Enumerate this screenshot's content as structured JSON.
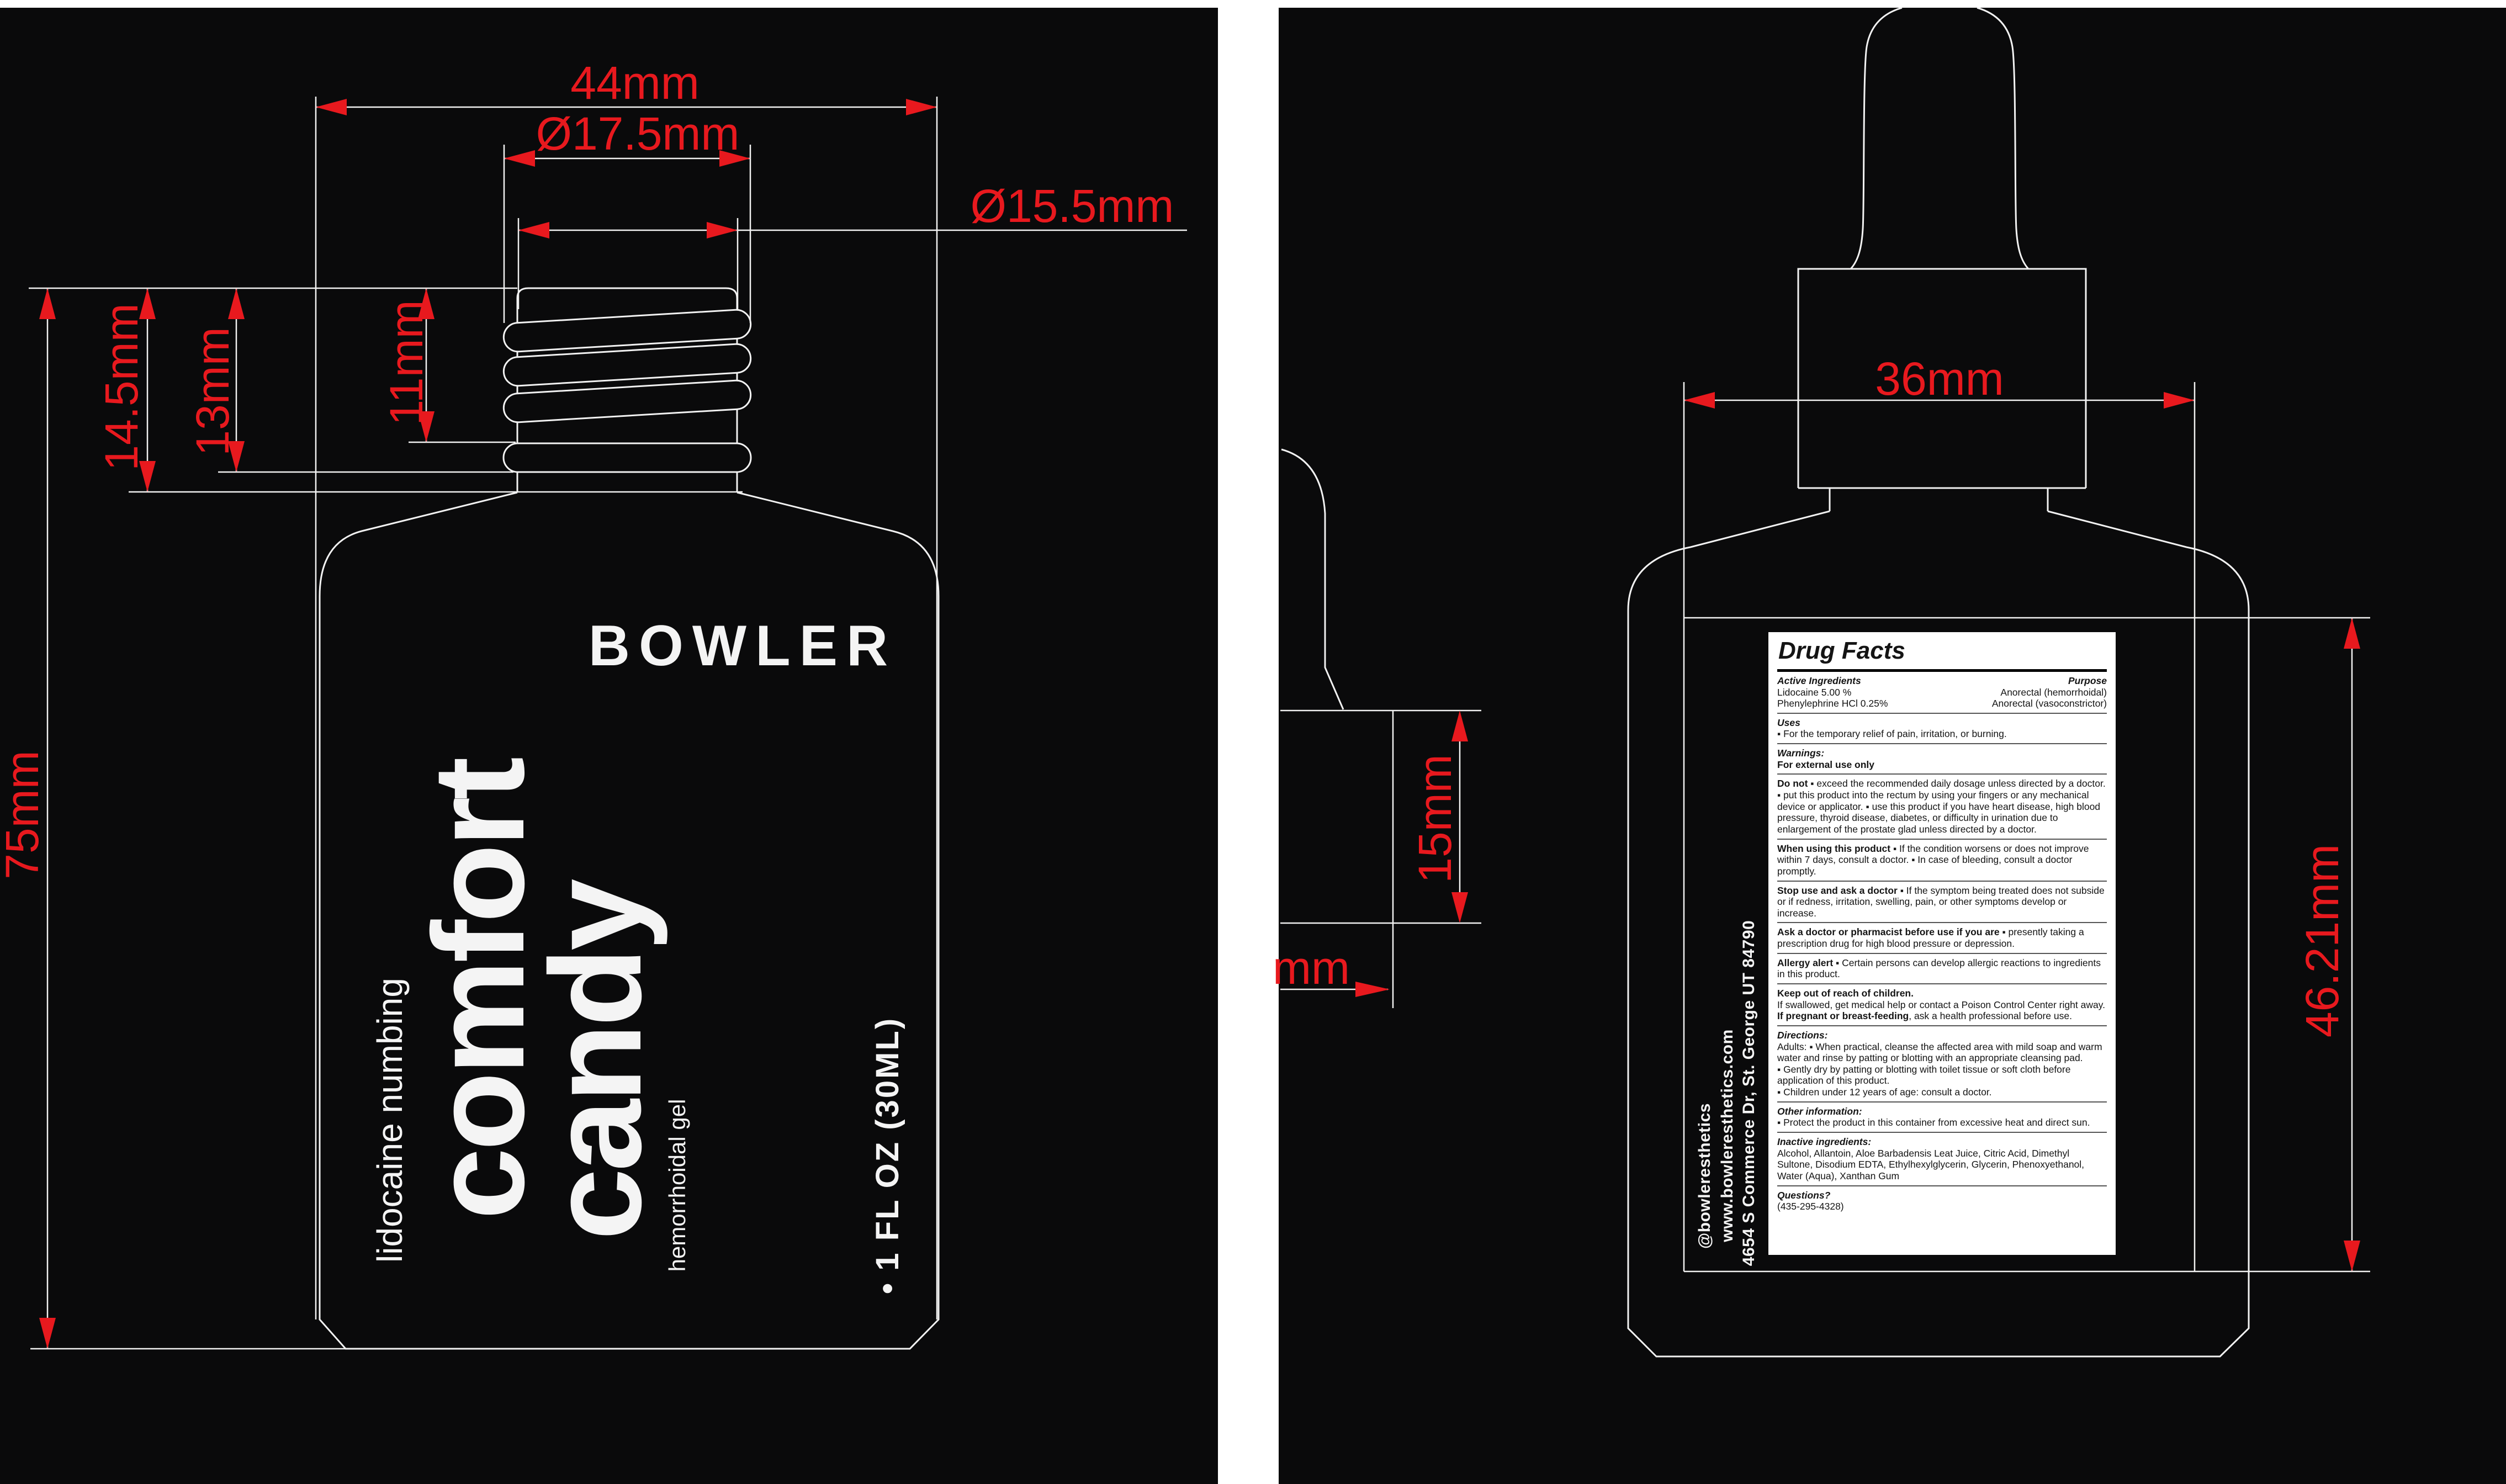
{
  "colors": {
    "accent_red": "#e8191e",
    "line_white": "#f2f2f2",
    "panel_background": "#0a0a0b",
    "label_text": "#f4f4f4"
  },
  "left_view": {
    "dims": {
      "body_width": "44mm",
      "cap_outer_diameter": "Ø17.5mm",
      "cap_diameter": "Ø15.5mm",
      "cap_height": "14.5mm",
      "collar_height": "13mm",
      "thread_height": "11mm",
      "bottle_height": "75mm"
    },
    "label": {
      "brand": "BOWLER",
      "title_line1": "comfort",
      "title_line2": "candy",
      "descriptor": "lidocaine numbing",
      "product_type": "hemorrhoidal gel",
      "volume": "• 1 FL OZ (30ML)"
    }
  },
  "right_view": {
    "dims": {
      "face_width": "36mm",
      "side_offset": "15mm",
      "side_offset_cut": "mm",
      "label_height": "46.21mm"
    },
    "company": {
      "social": "@bowleresthetics",
      "website": "www.bowleresthetics.com",
      "address": "4654 S Commerce Dr, St. George UT 84790"
    },
    "drug_facts": {
      "title": "Drug Facts",
      "active": {
        "heading": "Active Ingredients",
        "purpose_heading": "Purpose",
        "rows": [
          {
            "name": "Lidocaine 5.00 %",
            "purpose": "Anorectal (hemorrhoidal)"
          },
          {
            "name": "Phenylephrine HCl 0.25%",
            "purpose": "Anorectal (vasoconstrictor)"
          }
        ]
      },
      "uses": {
        "heading": "Uses",
        "text": "▪  For the temporary relief of pain, irritation, or burning."
      },
      "warnings": {
        "heading": "Warnings:",
        "text": "For external use only"
      },
      "do_not": {
        "lead": "Do not",
        "text": "  ▪  exceed the recommended daily dosage unless directed by a doctor.   ▪  put this product into the rectum by using your fingers or any mechanical device or applicator.   ▪  use this product if you have heart disease, high blood pressure, thyroid disease, diabetes, or difficulty in urination due to enlargement of the prostate glad unless directed by a doctor."
      },
      "when_using": {
        "lead": "When using this product",
        "text": "  ▪  If the condition worsens or does not improve within 7 days, consult a doctor.   ▪  In case of bleeding, consult a doctor promptly."
      },
      "stop_use": {
        "lead": "Stop use and ask a doctor",
        "text": "  ▪  If the symptom being treated does not subside or if redness, irritation, swelling, pain, or other symptoms develop or increase."
      },
      "ask_doctor": {
        "lead": "Ask a doctor or pharmacist before use if you are",
        "text": "  ▪  presently taking a prescription drug for high blood pressure or depression."
      },
      "allergy": {
        "lead": "Allergy alert",
        "text": "  ▪  Certain persons can develop allergic reactions to ingredients in this product."
      },
      "keep_out": {
        "heading": "Keep out of reach of children.",
        "text": "If swallowed, get medical help or contact a Poison Control Center right away.",
        "pregnant_lead": "If pregnant or breast-feeding",
        "pregnant_text": ", ask a health professional before use."
      },
      "directions": {
        "heading": "Directions:",
        "adults": "Adults:  ▪  When practical, cleanse the affected area with mild soap and warm water and rinse by patting or blotting with an appropriate cleansing pad.",
        "bullet2": "▪  Gently dry by patting or blotting with toilet tissue or soft cloth before application of this product.",
        "bullet3": "▪  Children under 12 years of age: consult a doctor."
      },
      "other": {
        "heading": "Other information:",
        "text": "▪  Protect the product in this container from excessive heat and direct sun."
      },
      "inactive": {
        "heading": "Inactive ingredients:",
        "text": "Alcohol, Allantoin, Aloe Barbadensis Leat Juice, Citric Acid, Dimethyl Sultone, Disodium EDTA, Ethylhexylglycerin, Glycerin, Phenoxyethanol, Water (Aqua), Xanthan Gum"
      },
      "questions": {
        "heading": "Questions?",
        "text": "(435-295-4328)"
      }
    }
  }
}
